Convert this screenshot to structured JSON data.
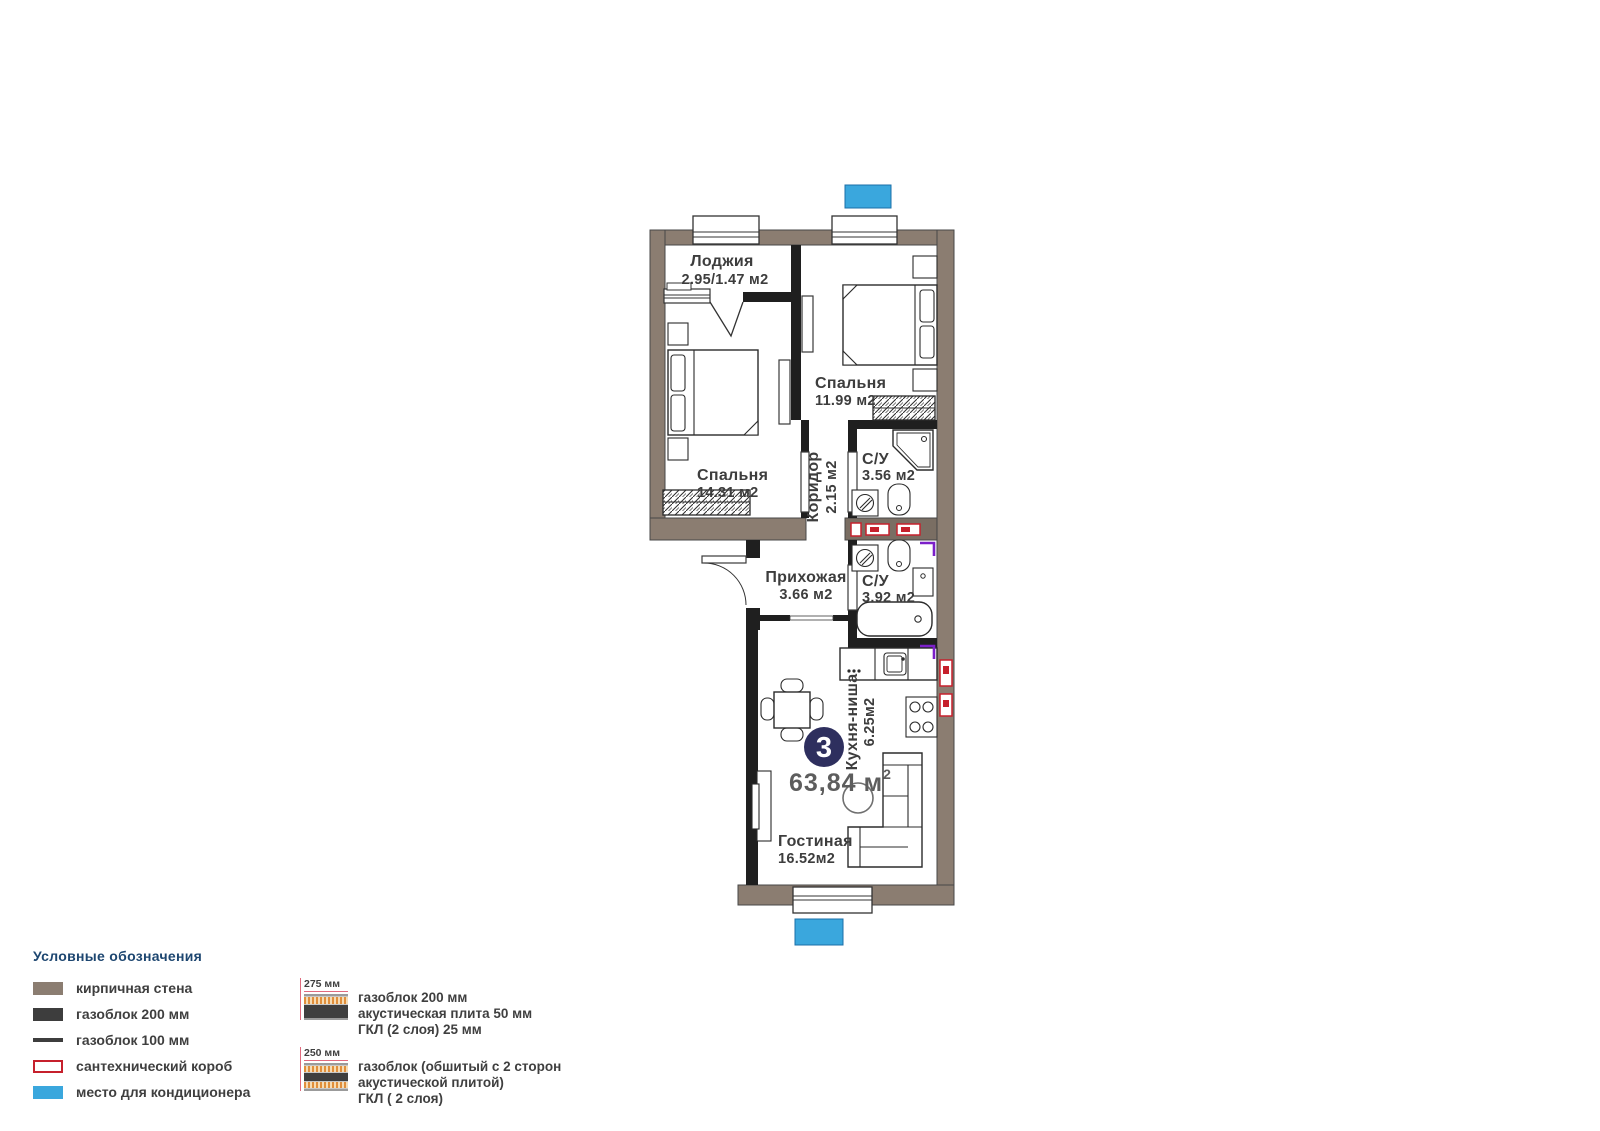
{
  "plan": {
    "badge": {
      "number": "3",
      "area": "63,84",
      "unit": "м",
      "power": "2"
    },
    "rooms": {
      "loggia": {
        "name": "Лоджия",
        "area": "2.95/1.47 м2"
      },
      "bedroom1": {
        "name": "Спальня",
        "area": "11.99 м2"
      },
      "bedroom2": {
        "name": "Спальня",
        "area": "14.31 м2"
      },
      "corridor": {
        "name": "Коридор",
        "area": "2.15 м2"
      },
      "bathroom1": {
        "name": "С/У",
        "area": "3.56 м2"
      },
      "bathroom2": {
        "name": "С/У",
        "area": "3.92 м2"
      },
      "hallway": {
        "name": "Прихожая",
        "area": "3.66 м2"
      },
      "kitchen": {
        "name": "Кухня-ниша",
        "area": "6.25м2"
      },
      "living": {
        "name": "Гостиная",
        "area": "16.52м2"
      }
    }
  },
  "legend": {
    "title": "Условные обозначения",
    "items": [
      {
        "label": "кирпичная стена"
      },
      {
        "label": "газоблок 200 мм"
      },
      {
        "label": "газоблок 100 мм"
      },
      {
        "label": "сантехнический короб"
      },
      {
        "label": "место для кондиционера"
      }
    ],
    "assemblies": [
      {
        "dim": "275 мм",
        "lines": [
          "газоблок 200 мм",
          "акустическая плита 50 мм",
          "ГКЛ (2 слоя) 25 мм"
        ]
      },
      {
        "dim": "250 мм",
        "lines": [
          "газоблок (обшитый с 2 сторон",
          "акустической плитой)",
          "ГКЛ ( 2 слоя)"
        ]
      }
    ]
  },
  "colors": {
    "brick": "#8b7d71",
    "block": "#1f1f1f",
    "ac_blue": "#3aa7dd",
    "plumbing_red": "#c6202c",
    "badge_navy": "#2e2f5e",
    "purple": "#7b1fc9",
    "legend_title": "#1d4670"
  }
}
